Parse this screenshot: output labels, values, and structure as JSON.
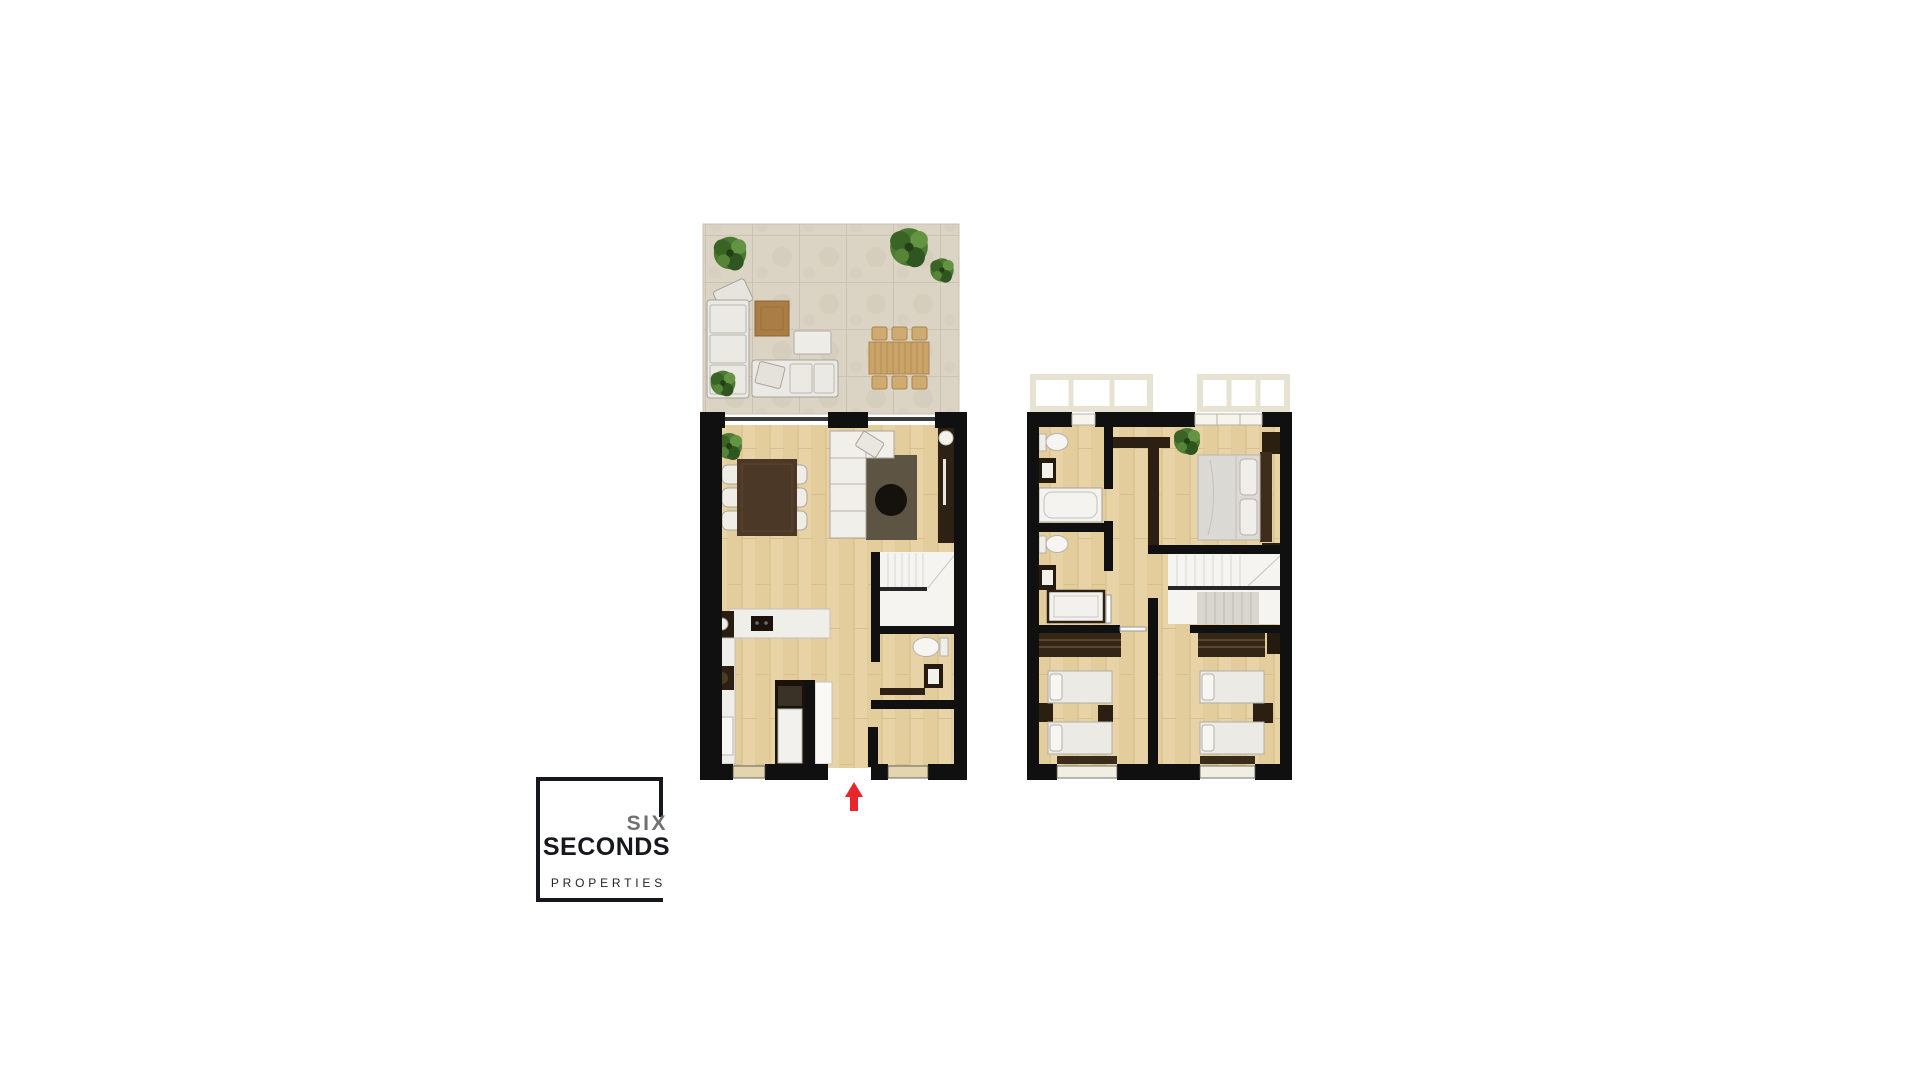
{
  "logo": {
    "word_top": "SIX",
    "word_main": "SECONDS",
    "word_sub": "PROPERTIES"
  },
  "colors": {
    "background": "#ffffff",
    "wall": "#101010",
    "wood_floor": "#e7d2a4",
    "terrace_stone": "#dbd3c4",
    "furniture_white": "#f1efe9",
    "dark_wood": "#4c3826",
    "rug_brown": "#5d5444",
    "plant_green": "#4c7a33",
    "arrow_red": "#e7252b",
    "logo_dark": "#17171f",
    "logo_gray": "#707070"
  }
}
